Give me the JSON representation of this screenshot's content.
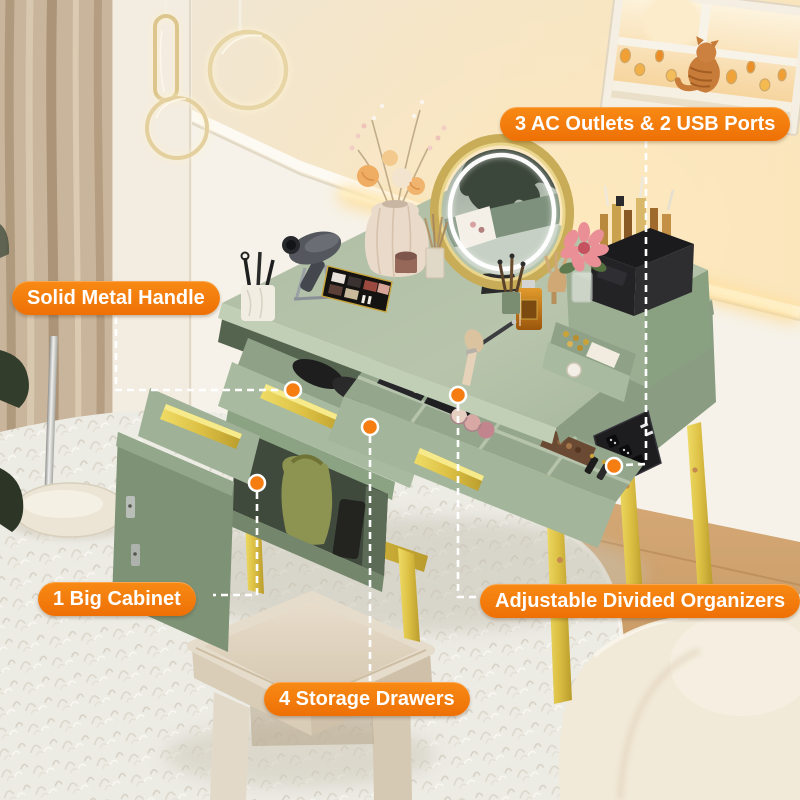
{
  "callouts": [
    {
      "id": "ac-usb-ports",
      "text": "3 AC Outlets & 2 USB Ports"
    },
    {
      "id": "solid-metal-handle",
      "text": "Solid Metal Handle"
    },
    {
      "id": "big-cabinet",
      "text": "1 Big Cabinet"
    },
    {
      "id": "divided-organizers",
      "text": "Adjustable Divided Organizers"
    },
    {
      "id": "storage-drawers",
      "text": "4 Storage Drawers"
    }
  ],
  "colors": {
    "callout_background": "#f2750a",
    "callout_text": "#ffffff",
    "connector_line": "#ffffff",
    "connector_dot": "#f57d12",
    "vanity_green": "#a9bba0",
    "handle_gold": "#e9d44e",
    "wall_cream": "#f0e6d4",
    "rug_white": "#edebe5"
  }
}
